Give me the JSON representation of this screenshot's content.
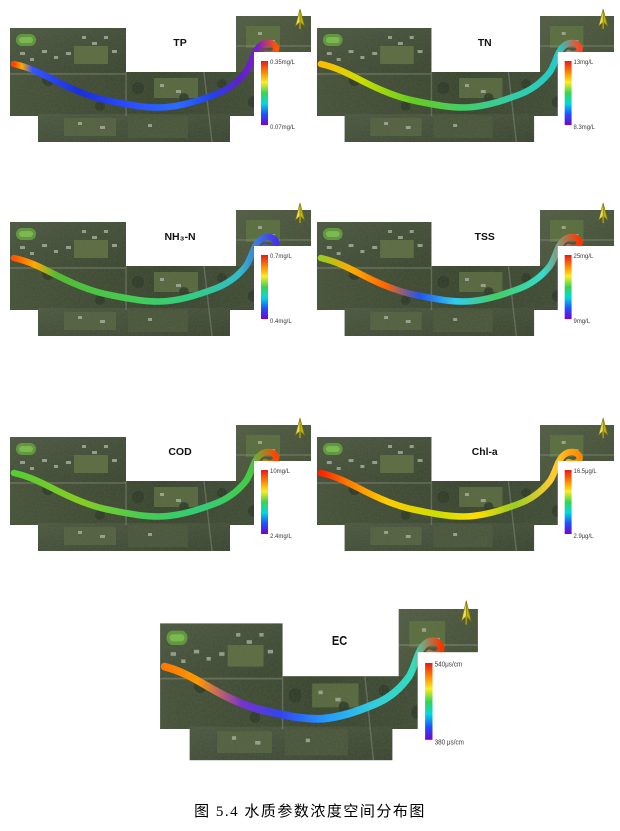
{
  "figure": {
    "caption": "图 5.4  水质参数浓度空间分布图"
  },
  "colors": {
    "colorbar_stops": [
      "#e31a1c",
      "#ff7f00",
      "#fcee21",
      "#39d353",
      "#00d9e0",
      "#1e50ff",
      "#7a00cc"
    ],
    "north_arrow": "#d8c80a",
    "legend_background": "#ffffff"
  },
  "panels": [
    {
      "id": "tp",
      "title": "TP",
      "max_label": "0.35mg/L",
      "min_label": "0.07mg/L",
      "river_gradient": [
        [
          0,
          "#ff4400"
        ],
        [
          0.03,
          "#ffaa00"
        ],
        [
          0.07,
          "#3355ff"
        ],
        [
          0.25,
          "#1b2fd6"
        ],
        [
          0.45,
          "#2a50ff"
        ],
        [
          0.62,
          "#2e6bff"
        ],
        [
          0.75,
          "#2244ee"
        ],
        [
          0.85,
          "#5a22cc"
        ],
        [
          0.93,
          "#7a1fd0"
        ],
        [
          1,
          "#ff5500"
        ]
      ]
    },
    {
      "id": "tn",
      "title": "TN",
      "max_label": "13mg/L",
      "min_label": "8.3mg/L",
      "river_gradient": [
        [
          0,
          "#ffbb00"
        ],
        [
          0.15,
          "#ccdd00"
        ],
        [
          0.35,
          "#66cc22"
        ],
        [
          0.55,
          "#44cc66"
        ],
        [
          0.75,
          "#33ccaa"
        ],
        [
          0.92,
          "#22cccc"
        ],
        [
          1,
          "#ff4422"
        ]
      ]
    },
    {
      "id": "nh3n",
      "title": "NH₃-N",
      "max_label": "0.7mg/L",
      "min_label": "0.4mg/L",
      "river_gradient": [
        [
          0,
          "#ff5500"
        ],
        [
          0.08,
          "#ffaa00"
        ],
        [
          0.16,
          "#55bb33"
        ],
        [
          0.45,
          "#44cc55"
        ],
        [
          0.7,
          "#33cc88"
        ],
        [
          0.86,
          "#33bbcc"
        ],
        [
          1,
          "#4433ee"
        ]
      ]
    },
    {
      "id": "tss",
      "title": "TSS",
      "max_label": "25mg/L",
      "min_label": "9mg/L",
      "river_gradient": [
        [
          0,
          "#99cc22"
        ],
        [
          0.12,
          "#ffaa00"
        ],
        [
          0.25,
          "#ff6600"
        ],
        [
          0.38,
          "#2255ee"
        ],
        [
          0.52,
          "#33ccee"
        ],
        [
          0.68,
          "#44cc66"
        ],
        [
          0.86,
          "#33ddcc"
        ],
        [
          1,
          "#ff3300"
        ]
      ]
    },
    {
      "id": "cod",
      "title": "COD",
      "max_label": "10mg/L",
      "min_label": "2.4mg/L",
      "river_gradient": [
        [
          0,
          "#55cc33"
        ],
        [
          0.25,
          "#88cc22"
        ],
        [
          0.5,
          "#44cc55"
        ],
        [
          0.72,
          "#33cc77"
        ],
        [
          0.9,
          "#44cc44"
        ],
        [
          1,
          "#ff4400"
        ]
      ]
    },
    {
      "id": "chla",
      "title": "Chl-a",
      "max_label": "16.5μg/L",
      "min_label": "2.9μg/L",
      "river_gradient": [
        [
          0,
          "#ff2200"
        ],
        [
          0.1,
          "#ff7700"
        ],
        [
          0.25,
          "#ffcc00"
        ],
        [
          0.45,
          "#ccdd00"
        ],
        [
          0.6,
          "#ffdd00"
        ],
        [
          0.75,
          "#99cc22"
        ],
        [
          0.9,
          "#ffcc33"
        ],
        [
          1,
          "#ff8800"
        ]
      ]
    },
    {
      "id": "ec",
      "title": "EC",
      "max_label": "540μs/cm",
      "min_label": "380 μs/cm",
      "river_gradient": [
        [
          0,
          "#ff7700"
        ],
        [
          0.12,
          "#ff9900"
        ],
        [
          0.28,
          "#7733cc"
        ],
        [
          0.42,
          "#3344ee"
        ],
        [
          0.58,
          "#2299ff"
        ],
        [
          0.75,
          "#33ccdd"
        ],
        [
          0.9,
          "#33ddbb"
        ],
        [
          1,
          "#ff3300"
        ]
      ]
    }
  ]
}
